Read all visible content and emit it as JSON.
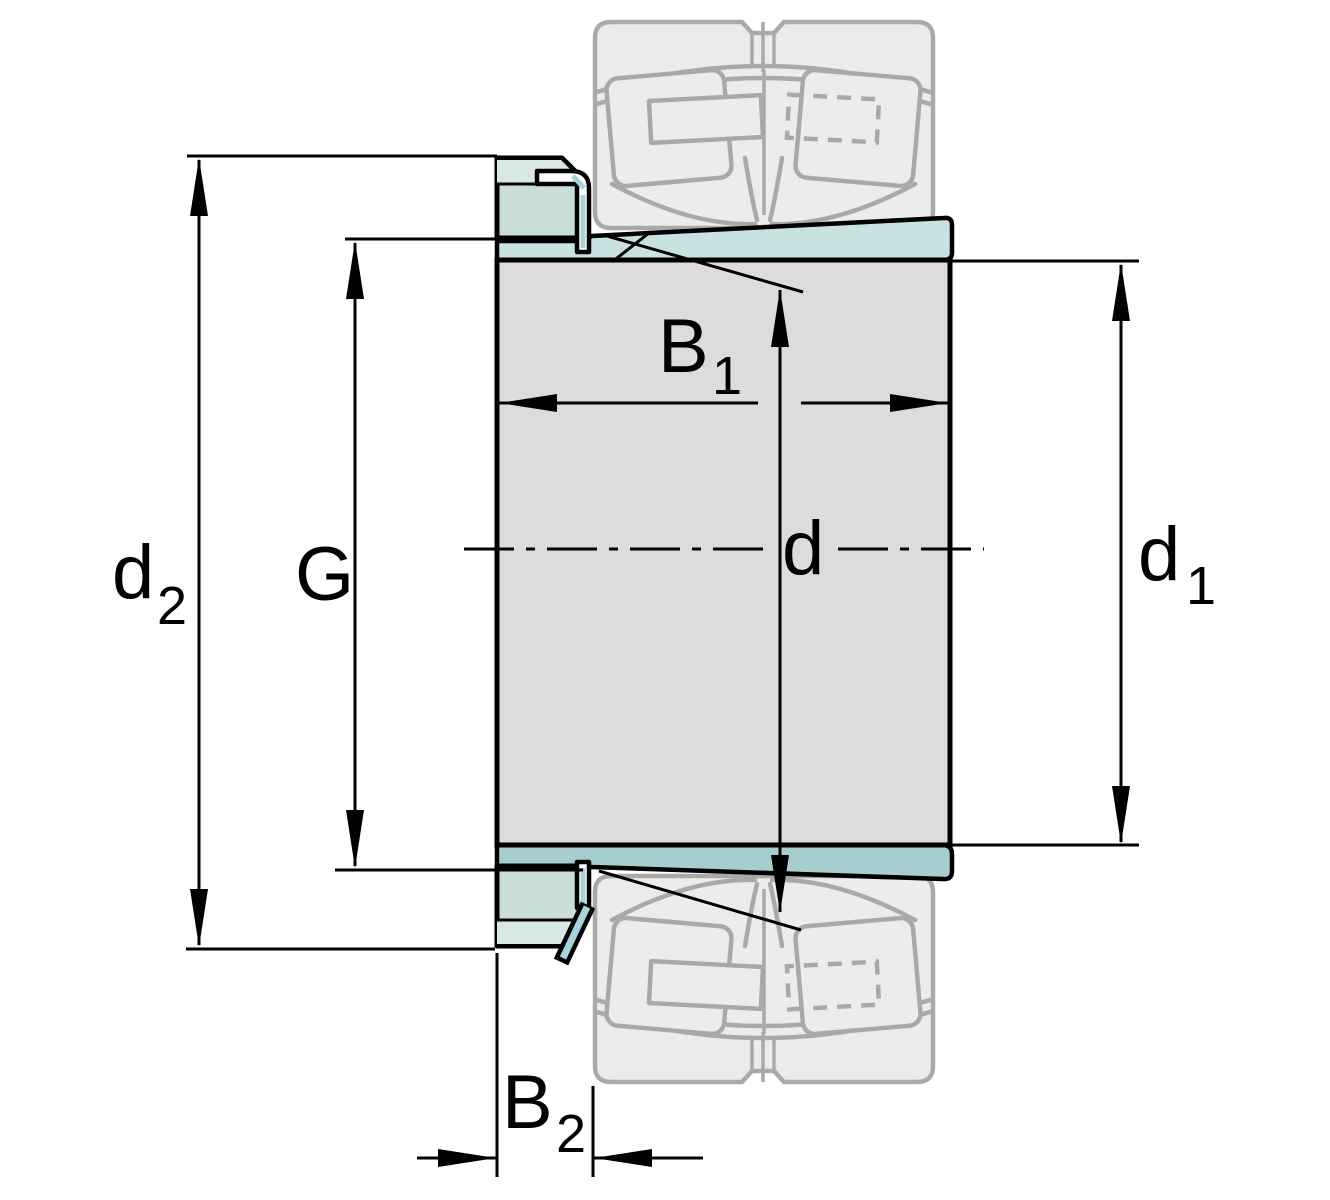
{
  "dimension_labels": {
    "d2": {
      "base": "d",
      "sub": "2"
    },
    "g": {
      "base": "G",
      "sub": ""
    },
    "b1": {
      "base": "B",
      "sub": "1"
    },
    "d": {
      "base": "d",
      "sub": ""
    },
    "d1": {
      "base": "d",
      "sub": "1"
    },
    "b2": {
      "base": "B",
      "sub": "2"
    }
  },
  "colors": {
    "line_black": "#000000",
    "sleeve_gray": "#dcdcdc",
    "taper_top_teal": "#c8e2e2",
    "taper_bottom_teal": "#a6cecf",
    "nut_teal": "#c9ded9",
    "nut_light_teal": "#d9e8e4",
    "washer_cyan": "#a6d3dd",
    "ghost_fill": "#ececec",
    "ghost_stroke": "#a9a9a9",
    "background": "#ffffff"
  }
}
